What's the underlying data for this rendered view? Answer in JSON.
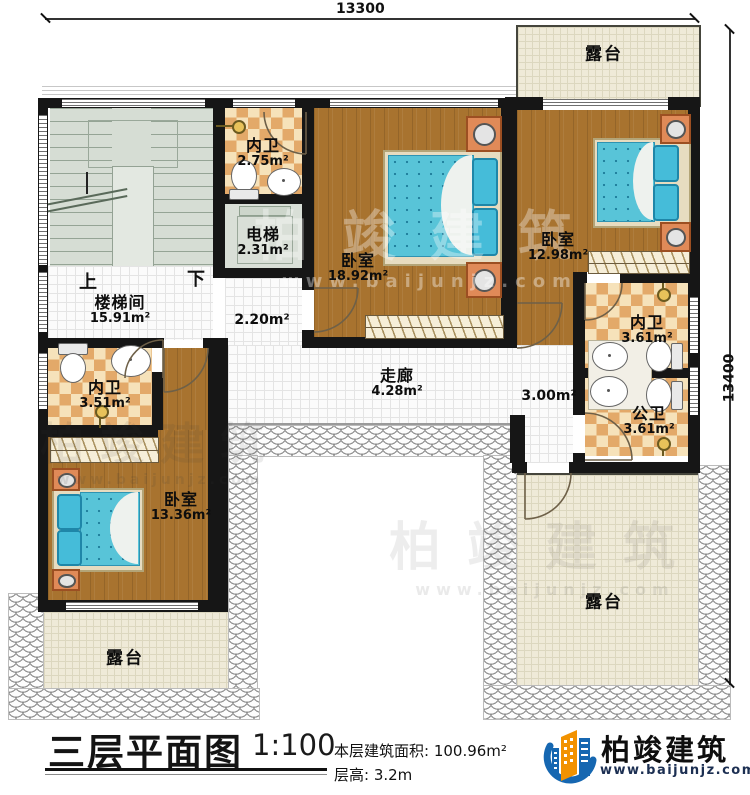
{
  "dimensions": {
    "top": "13300",
    "right": "13400"
  },
  "rooms": {
    "terrace_top": {
      "name": "露台"
    },
    "terrace_bottom_left": {
      "name": "露台"
    },
    "terrace_bottom_right": {
      "name": "露台"
    },
    "stairwell": {
      "name": "楼梯间",
      "area": "15.91m²",
      "up": "上",
      "down": "下"
    },
    "bath_top": {
      "name": "内卫",
      "area": "2.75m²"
    },
    "elevator": {
      "name": "电梯",
      "area": "2.31m²"
    },
    "bedroom_center": {
      "name": "卧室",
      "area": "18.92m²"
    },
    "bedroom_right": {
      "name": "卧室",
      "area": "12.98m²"
    },
    "bath_right": {
      "name": "内卫",
      "area": "3.61m²"
    },
    "bath_public": {
      "name": "公卫",
      "area": "3.61m²"
    },
    "bath_left": {
      "name": "内卫",
      "area": "3.51m²"
    },
    "bedroom_left": {
      "name": "卧室",
      "area": "13.36m²"
    },
    "corridor": {
      "name": "走廊",
      "area": "4.28m²"
    },
    "hall_small": {
      "area": "2.20m²"
    },
    "hall_right": {
      "area": "3.00m²"
    }
  },
  "footer": {
    "title": "三层平面图",
    "scale": "1:100",
    "area_label": "本层建筑面积: 100.96m²",
    "height_label": "层高: 3.2m"
  },
  "logo": {
    "brand": "柏竣建筑",
    "url": "www.baijunjz.com"
  },
  "watermark": {
    "brand": "柏竣建筑",
    "url": "www.baijunjz.com"
  },
  "colors": {
    "wall": "#161616",
    "wood": "#a8732f",
    "accent_blue": "#1667b1",
    "accent_orange": "#f29200",
    "mattress": "#58c4d8"
  }
}
